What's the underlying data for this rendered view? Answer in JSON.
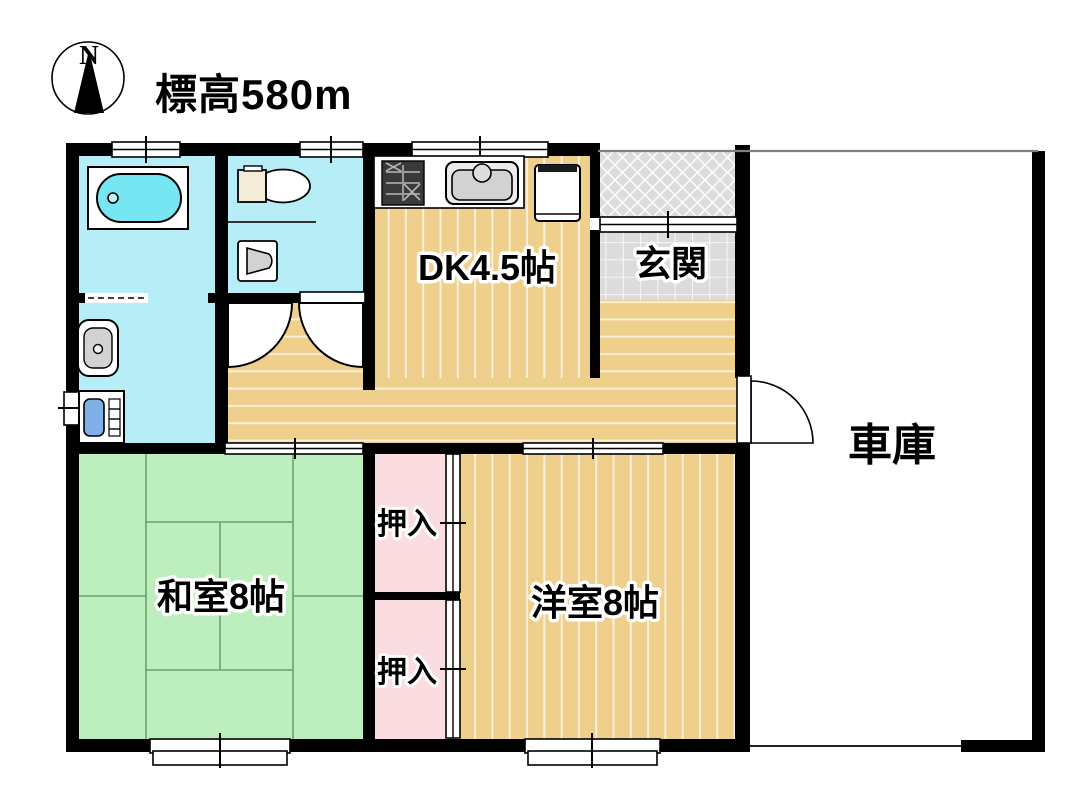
{
  "title": {
    "elevation": "標高580m"
  },
  "compass": {
    "north": "N"
  },
  "rooms": {
    "dk": {
      "label": "DK4.5帖"
    },
    "genkan": {
      "label": "玄関"
    },
    "garage": {
      "label": "車庫"
    },
    "washitsu": {
      "label": "和室8帖"
    },
    "yoshitsu": {
      "label": "洋室8帖"
    },
    "closet_upper": {
      "label": "押入"
    },
    "closet_lower": {
      "label": "押入"
    }
  },
  "colors": {
    "wall": "#000000",
    "floor_tan": "#eecf8b",
    "tatami_green": "#bdeebd",
    "water_cyan": "#b6edf7",
    "tub_cyan": "#76e7f2",
    "closet_pink": "#fbdce0",
    "tile_gray": "#dcdcdc",
    "machine_blue": "#7fb1e8",
    "appliance_gray": "#d2d2d2",
    "tank_cream": "#f2ecd8"
  }
}
